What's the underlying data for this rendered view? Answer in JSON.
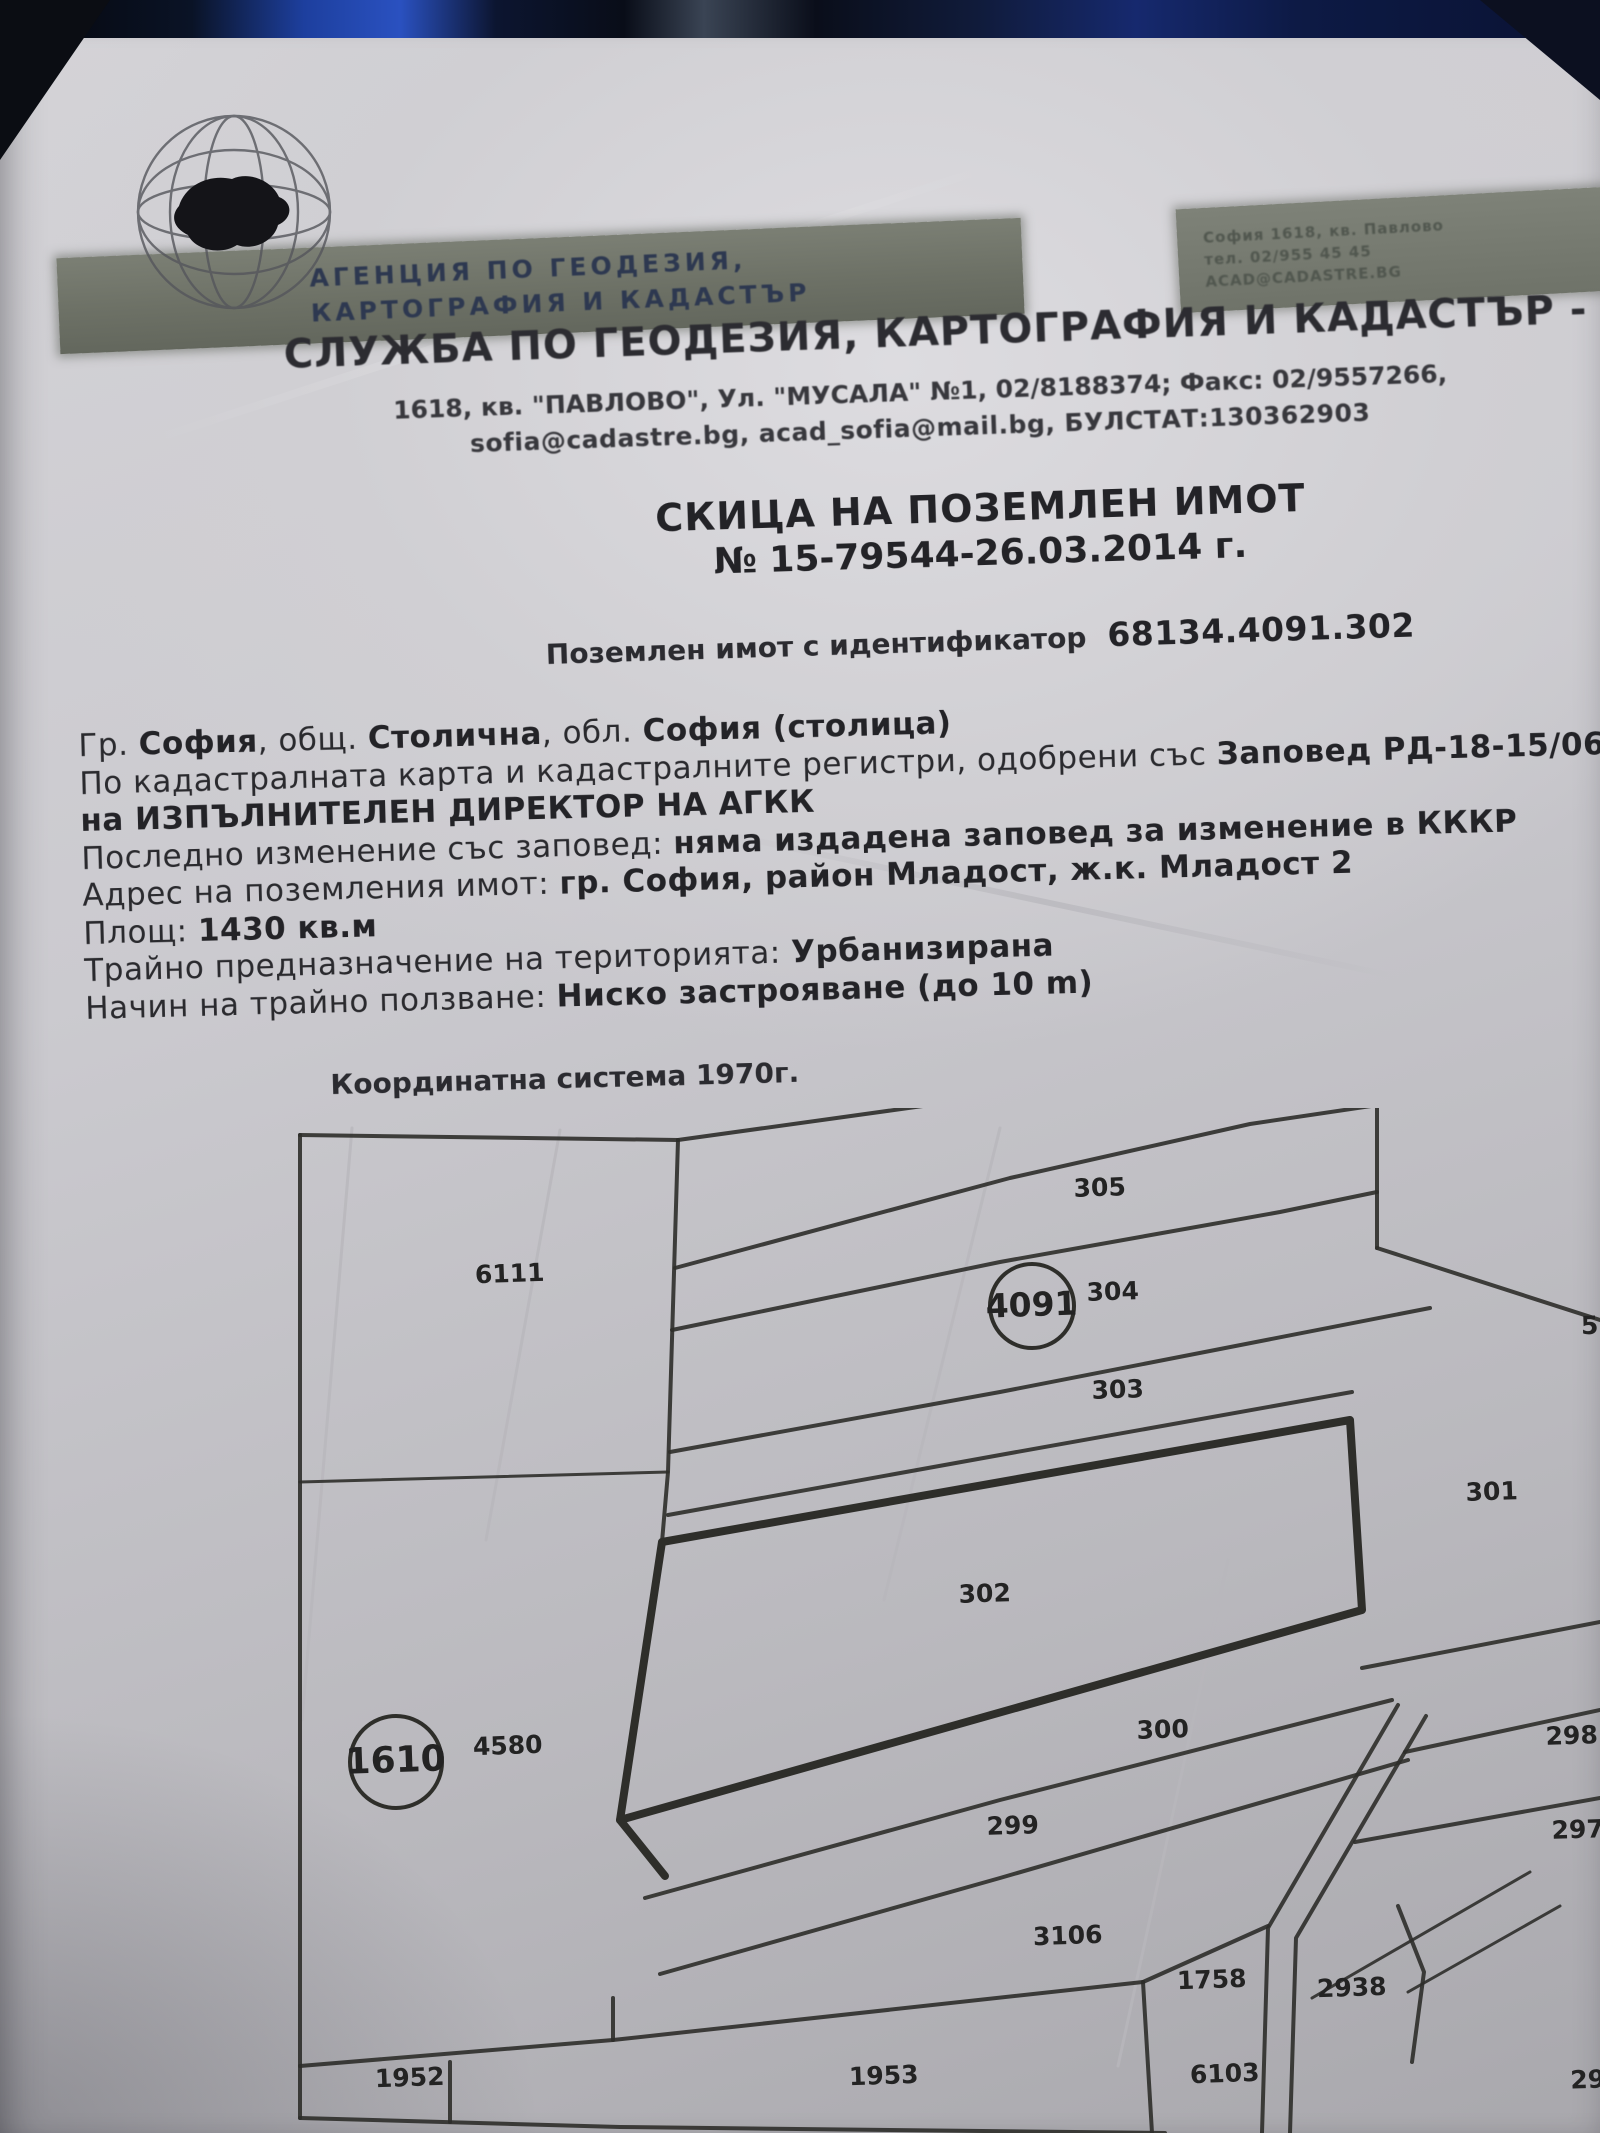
{
  "colors": {
    "paper": "#cfced3",
    "ink": "#2a2a2e",
    "map_line": "#2e2e2a",
    "banner": "#6d7166",
    "banner_text": "#2d3850",
    "photo_strip_blue": "#2a51c0",
    "photo_strip_dark": "#0a0c12"
  },
  "header": {
    "logo": "globe-with-bulgaria-map",
    "banner_line1": "АГЕНЦИЯ ПО ГЕОДЕЗИЯ,",
    "banner_line2": "КАРТОГРАФИЯ И КАДАСТЪР",
    "right_note_lines": [
      "София 1618, кв. Павлово",
      "тел. 02/955 45 45",
      "ACAD@CADASTRE.BG"
    ],
    "office_title": "СЛУЖБА ПО ГЕОДЕЗИЯ, КАРТОГРАФИЯ И КАДАСТЪР - ГР. СОФИЯ",
    "address_line1": "1618, кв. \"ПАВЛОВО\", Ул. \"МУСАЛА\" №1, 02/8188374; Факс: 02/9557266,",
    "address_line2": "sofia@cadastre.bg, acad_sofia@mail.bg, БУЛСТАТ:130362903"
  },
  "document": {
    "title": "СКИЦА НА ПОЗЕМЛЕН ИМОТ",
    "number_line": "№ 15-79544-26.03.2014 г.",
    "id_label": "Поземлен имот с  идентификатор",
    "id_value": "68134.4091.302",
    "info_lines": [
      [
        {
          "t": "Гр. ",
          "b": false
        },
        {
          "t": "София",
          "b": true
        },
        {
          "t": ", общ. ",
          "b": false
        },
        {
          "t": "Столична",
          "b": true
        },
        {
          "t": ", обл. ",
          "b": false
        },
        {
          "t": "София (столица)",
          "b": true
        }
      ],
      [
        {
          "t": "По кадастралната карта и кадастралните регистри, одобрени със ",
          "b": false
        },
        {
          "t": "Заповед РД-18-15/06.0",
          "b": true
        }
      ],
      [
        {
          "t": "на ИЗПЪЛНИТЕЛЕН ДИРЕКТОР НА АГКК",
          "b": true
        }
      ],
      [
        {
          "t": "Последно изменение със заповед: ",
          "b": false
        },
        {
          "t": "няма издадена заповед за изменение в КККР",
          "b": true
        }
      ],
      [
        {
          "t": "Адрес на поземления имот: ",
          "b": false
        },
        {
          "t": "гр. София, район Младост, ж.к. Младост 2",
          "b": true
        }
      ],
      [
        {
          "t": "Площ: ",
          "b": false
        },
        {
          "t": "1430 кв.м",
          "b": true
        }
      ],
      [
        {
          "t": "Трайно предназначение на територията: ",
          "b": false
        },
        {
          "t": "Урбанизирана",
          "b": true
        }
      ],
      [
        {
          "t": "Начин на трайно ползване: ",
          "b": false
        },
        {
          "t": "Ниско застрояване (до 10 m)",
          "b": true
        }
      ]
    ]
  },
  "map": {
    "coord_system_label": "Координатна система 1970г.",
    "subject_parcel": "302",
    "parcels": [
      {
        "label": "305",
        "x": 1100,
        "y": 1196
      },
      {
        "label": "6111",
        "x": 510,
        "y": 1282
      },
      {
        "label": "4091",
        "x": 1032,
        "y": 1316,
        "circled": true,
        "r": 42,
        "fs": 33
      },
      {
        "label": "304",
        "x": 1113,
        "y": 1300
      },
      {
        "label": "303",
        "x": 1118,
        "y": 1398
      },
      {
        "label": "301",
        "x": 1492,
        "y": 1500
      },
      {
        "label": "302",
        "x": 985,
        "y": 1602
      },
      {
        "label": "300",
        "x": 1163,
        "y": 1738
      },
      {
        "label": "298",
        "x": 1572,
        "y": 1744
      },
      {
        "label": "1610",
        "x": 396,
        "y": 1772,
        "circled": true,
        "r": 46,
        "fs": 36
      },
      {
        "label": "4580",
        "x": 508,
        "y": 1754
      },
      {
        "label": "299",
        "x": 1013,
        "y": 1834
      },
      {
        "label": "297",
        "x": 1578,
        "y": 1838
      },
      {
        "label": "3106",
        "x": 1068,
        "y": 1944
      },
      {
        "label": "1758",
        "x": 1212,
        "y": 1988
      },
      {
        "label": "2938",
        "x": 1352,
        "y": 1996
      },
      {
        "label": "6103",
        "x": 1225,
        "y": 2082
      },
      {
        "label": "1952",
        "x": 410,
        "y": 2086
      },
      {
        "label": "1953",
        "x": 884,
        "y": 2084
      },
      {
        "label": "5",
        "x": 1590,
        "y": 1334
      },
      {
        "label": "29",
        "x": 1588,
        "y": 2088
      }
    ],
    "lines": [
      {
        "pts": [
          [
            300,
            1135
          ],
          [
            300,
            2118
          ]
        ],
        "w": 4
      },
      {
        "pts": [
          [
            300,
            1135
          ],
          [
            678,
            1140
          ]
        ],
        "w": 4
      },
      {
        "pts": [
          [
            300,
            2118
          ],
          [
            620,
            2127
          ],
          [
            1165,
            2133
          ]
        ],
        "w": 4
      },
      {
        "pts": [
          [
            678,
            1140
          ],
          [
            1600,
            1012
          ]
        ],
        "w": 4
      },
      {
        "pts": [
          [
            675,
            1268
          ],
          [
            1010,
            1178
          ],
          [
            1250,
            1124
          ],
          [
            1600,
            1072
          ]
        ],
        "w": 4
      },
      {
        "pts": [
          [
            672,
            1330
          ],
          [
            1000,
            1262
          ],
          [
            1280,
            1212
          ],
          [
            1377,
            1192
          ]
        ],
        "w": 4
      },
      {
        "pts": [
          [
            1377,
            1078
          ],
          [
            1377,
            1248
          ]
        ],
        "w": 4
      },
      {
        "pts": [
          [
            1377,
            1248
          ],
          [
            1600,
            1320
          ]
        ],
        "w": 4
      },
      {
        "pts": [
          [
            670,
            1452
          ],
          [
            1000,
            1392
          ],
          [
            1430,
            1308
          ]
        ],
        "w": 4
      },
      {
        "pts": [
          [
            668,
            1515
          ],
          [
            1000,
            1455
          ],
          [
            1352,
            1392
          ]
        ],
        "w": 4
      },
      {
        "pts": [
          [
            678,
            1140
          ],
          [
            668,
            1472
          ],
          [
            662,
            1542
          ]
        ],
        "w": 4
      },
      {
        "pts": [
          [
            300,
            1482
          ],
          [
            668,
            1472
          ]
        ],
        "w": 3
      },
      {
        "pts": [
          [
            662,
            1542
          ],
          [
            1350,
            1420
          ],
          [
            1362,
            1610
          ],
          [
            620,
            1820
          ],
          [
            662,
            1542
          ]
        ],
        "w": 8
      },
      {
        "pts": [
          [
            620,
            1820
          ],
          [
            665,
            1876
          ]
        ],
        "w": 8
      },
      {
        "pts": [
          [
            645,
            1898
          ],
          [
            1000,
            1800
          ],
          [
            1392,
            1700
          ]
        ],
        "w": 4
      },
      {
        "pts": [
          [
            660,
            1974
          ],
          [
            1000,
            1878
          ],
          [
            1408,
            1760
          ]
        ],
        "w": 4
      },
      {
        "pts": [
          [
            1362,
            1668
          ],
          [
            1600,
            1622
          ]
        ],
        "w": 4
      },
      {
        "pts": [
          [
            1405,
            1752
          ],
          [
            1600,
            1710
          ]
        ],
        "w": 4
      },
      {
        "pts": [
          [
            1355,
            1842
          ],
          [
            1600,
            1798
          ]
        ],
        "w": 4
      },
      {
        "pts": [
          [
            1398,
            1705
          ],
          [
            1268,
            1928
          ],
          [
            1262,
            2133
          ]
        ],
        "w": 4
      },
      {
        "pts": [
          [
            1426,
            1716
          ],
          [
            1296,
            1938
          ],
          [
            1290,
            2133
          ]
        ],
        "w": 4
      },
      {
        "pts": [
          [
            1530,
            1872
          ],
          [
            1312,
            1998
          ]
        ],
        "w": 3
      },
      {
        "pts": [
          [
            1560,
            1906
          ],
          [
            1408,
            1992
          ]
        ],
        "w": 3
      },
      {
        "pts": [
          [
            1398,
            1906
          ],
          [
            1424,
            1972
          ],
          [
            1412,
            2062
          ]
        ],
        "w": 4
      },
      {
        "pts": [
          [
            1143,
            1982
          ],
          [
            1268,
            1926
          ]
        ],
        "w": 4
      },
      {
        "pts": [
          [
            1143,
            1982
          ],
          [
            1152,
            2133
          ]
        ],
        "w": 4
      },
      {
        "pts": [
          [
            300,
            2066
          ],
          [
            613,
            2040
          ],
          [
            1143,
            1982
          ]
        ],
        "w": 4
      },
      {
        "pts": [
          [
            450,
            2062
          ],
          [
            450,
            2122
          ]
        ],
        "w": 4
      },
      {
        "pts": [
          [
            613,
            2040
          ],
          [
            613,
            1998
          ]
        ],
        "w": 4
      }
    ],
    "creases": [
      [
        [
          352,
          1128
        ],
        [
          302,
          1720
        ]
      ],
      [
        [
          1000,
          1128
        ],
        [
          884,
          1600
        ]
      ],
      [
        [
          1228,
          1560
        ],
        [
          1118,
          2066
        ]
      ],
      [
        [
          560,
          1130
        ],
        [
          486,
          1540
        ]
      ]
    ]
  }
}
